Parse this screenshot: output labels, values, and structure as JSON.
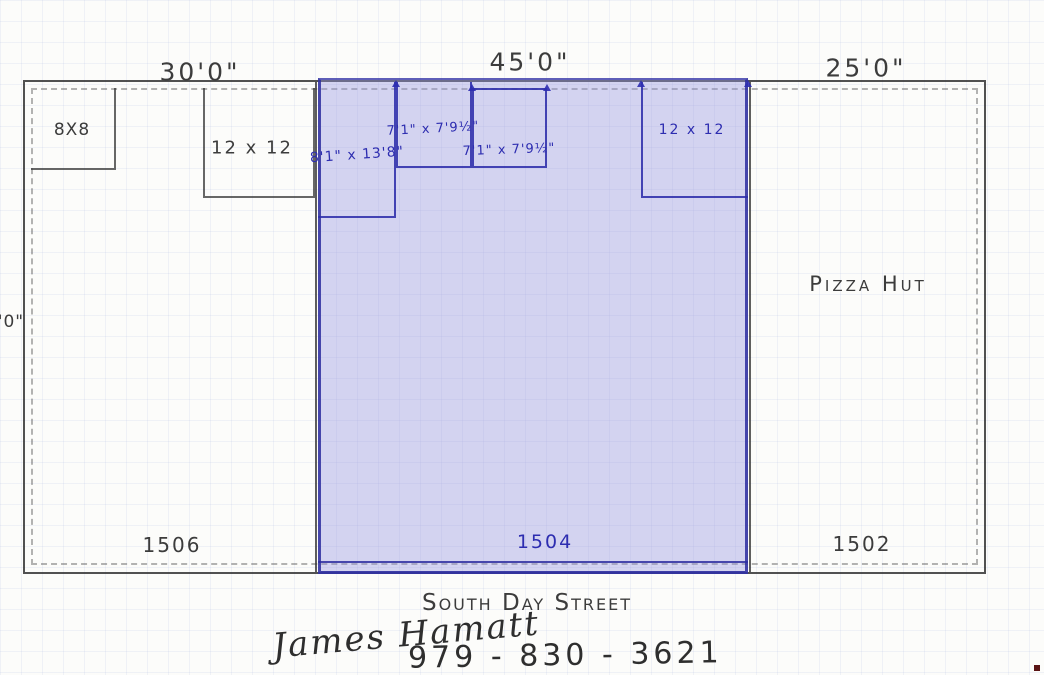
{
  "plan": {
    "top_dimensions": [
      {
        "label": "30'0\""
      },
      {
        "label": "45'0\""
      },
      {
        "label": "25'0\""
      }
    ],
    "left_dimension": "0'0\"",
    "street": "South Day Street",
    "units": [
      {
        "number": "1506",
        "rooms": [
          {
            "label": "8X8"
          },
          {
            "label": "12 x 12"
          }
        ]
      },
      {
        "number": "1504",
        "highlighted": true,
        "rooms": [
          {
            "label": "8'1\" x 13'8\""
          },
          {
            "label": "7'1\" x 7'9½\""
          },
          {
            "label": "7'1\" x 7'9½\""
          },
          {
            "label": "12 x 12"
          }
        ]
      },
      {
        "number": "1502",
        "tenant": "Pizza Hut",
        "rooms": []
      }
    ],
    "signature": "James Hamatt",
    "phone": "979 - 830 - 3621"
  },
  "colors": {
    "highlight_fill": "#cbcbef",
    "ink_blue": "#2d2db0",
    "pencil": "#474747"
  }
}
